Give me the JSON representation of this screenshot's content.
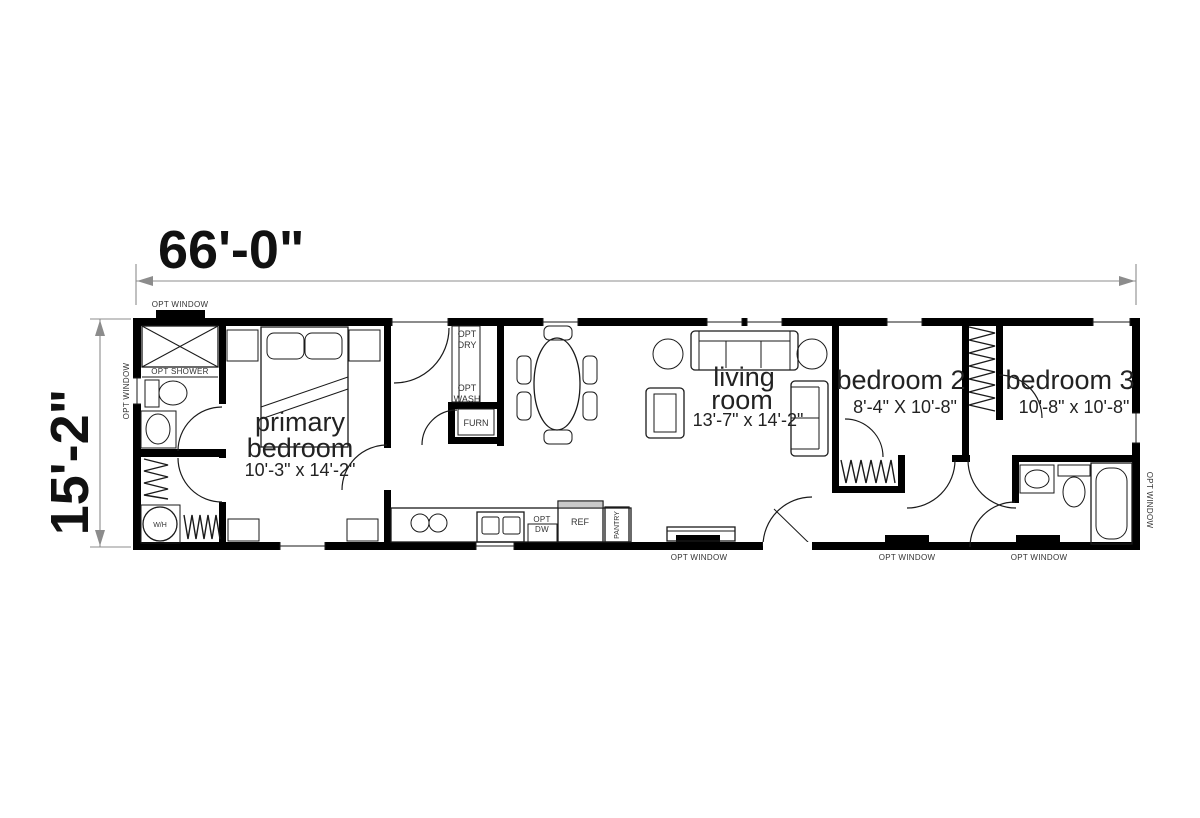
{
  "dimensions": {
    "overall_width": "66'-0\"",
    "overall_height": "15'-2\""
  },
  "rooms": {
    "primary_bedroom": {
      "name_line1": "primary",
      "name_line2": "bedroom",
      "size": "10'-3\" x 14'-2\""
    },
    "living_room": {
      "name_line1": "living",
      "name_line2": "room",
      "size": "13'-7\" x 14'-2\""
    },
    "bedroom_2": {
      "name": "bedroom 2",
      "size": "8'-4\" X 10'-8\""
    },
    "bedroom_3": {
      "name": "bedroom 3",
      "size": "10'-8\" x 10'-8\""
    }
  },
  "fixtures": {
    "opt_shower": "OPT SHOWER",
    "water_heater": "W/H",
    "opt_dryer": {
      "line1": "OPT",
      "line2": "DRY"
    },
    "opt_washer": {
      "line1": "OPT",
      "line2": "WASH"
    },
    "furnace": "FURN",
    "opt_dishwasher": {
      "line1": "OPT",
      "line2": "DW"
    },
    "refrigerator": "REF",
    "pantry": "PANTRY"
  },
  "windows": {
    "opt_window": "OPT WINDOW"
  },
  "colors": {
    "wall": "#000000",
    "dimension_line": "#8c8c8c",
    "background": "#ffffff"
  }
}
